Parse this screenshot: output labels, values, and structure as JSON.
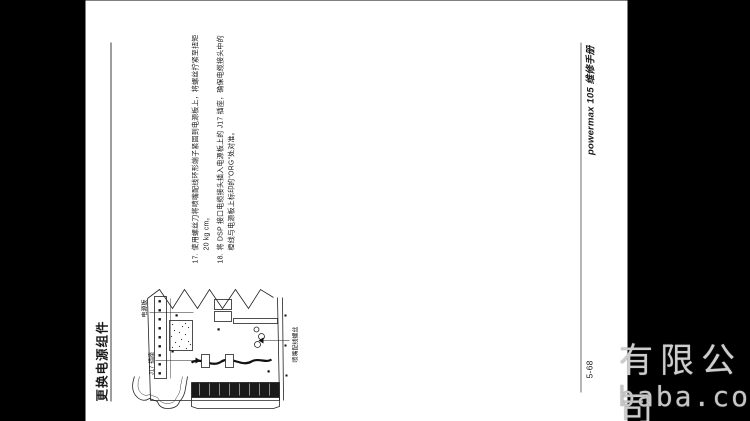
{
  "page": {
    "header": {
      "title": "更换电源组件"
    },
    "steps": [
      {
        "number": "17.",
        "lines": [
          "使用螺丝刀将喷嘴配线环形端子紧固到电源板上，将螺丝拧紧至扭矩",
          "20 kg cm。"
        ]
      },
      {
        "number": "18.",
        "lines": [
          "将 DSP 接口电缆接头插入电源板上的 J17 插座，确保电缆接头中的",
          "橙线与电源板上标印的“ORG”处对准。"
        ]
      }
    ],
    "figure": {
      "labels": {
        "power_board": "电源板",
        "j17": "J17 插座",
        "nozzle_wire_screw": "喷嘴配线螺丝"
      }
    },
    "footer": {
      "page_number": "5-68",
      "manual_title": "powermax 105 维修手册"
    }
  },
  "watermark": {
    "line1": "有限公司",
    "line2": "baba.com"
  },
  "colors": {
    "background": "#000000",
    "page": "#ffffff",
    "text": "#1a1a1a",
    "watermark": "#cccccc"
  }
}
